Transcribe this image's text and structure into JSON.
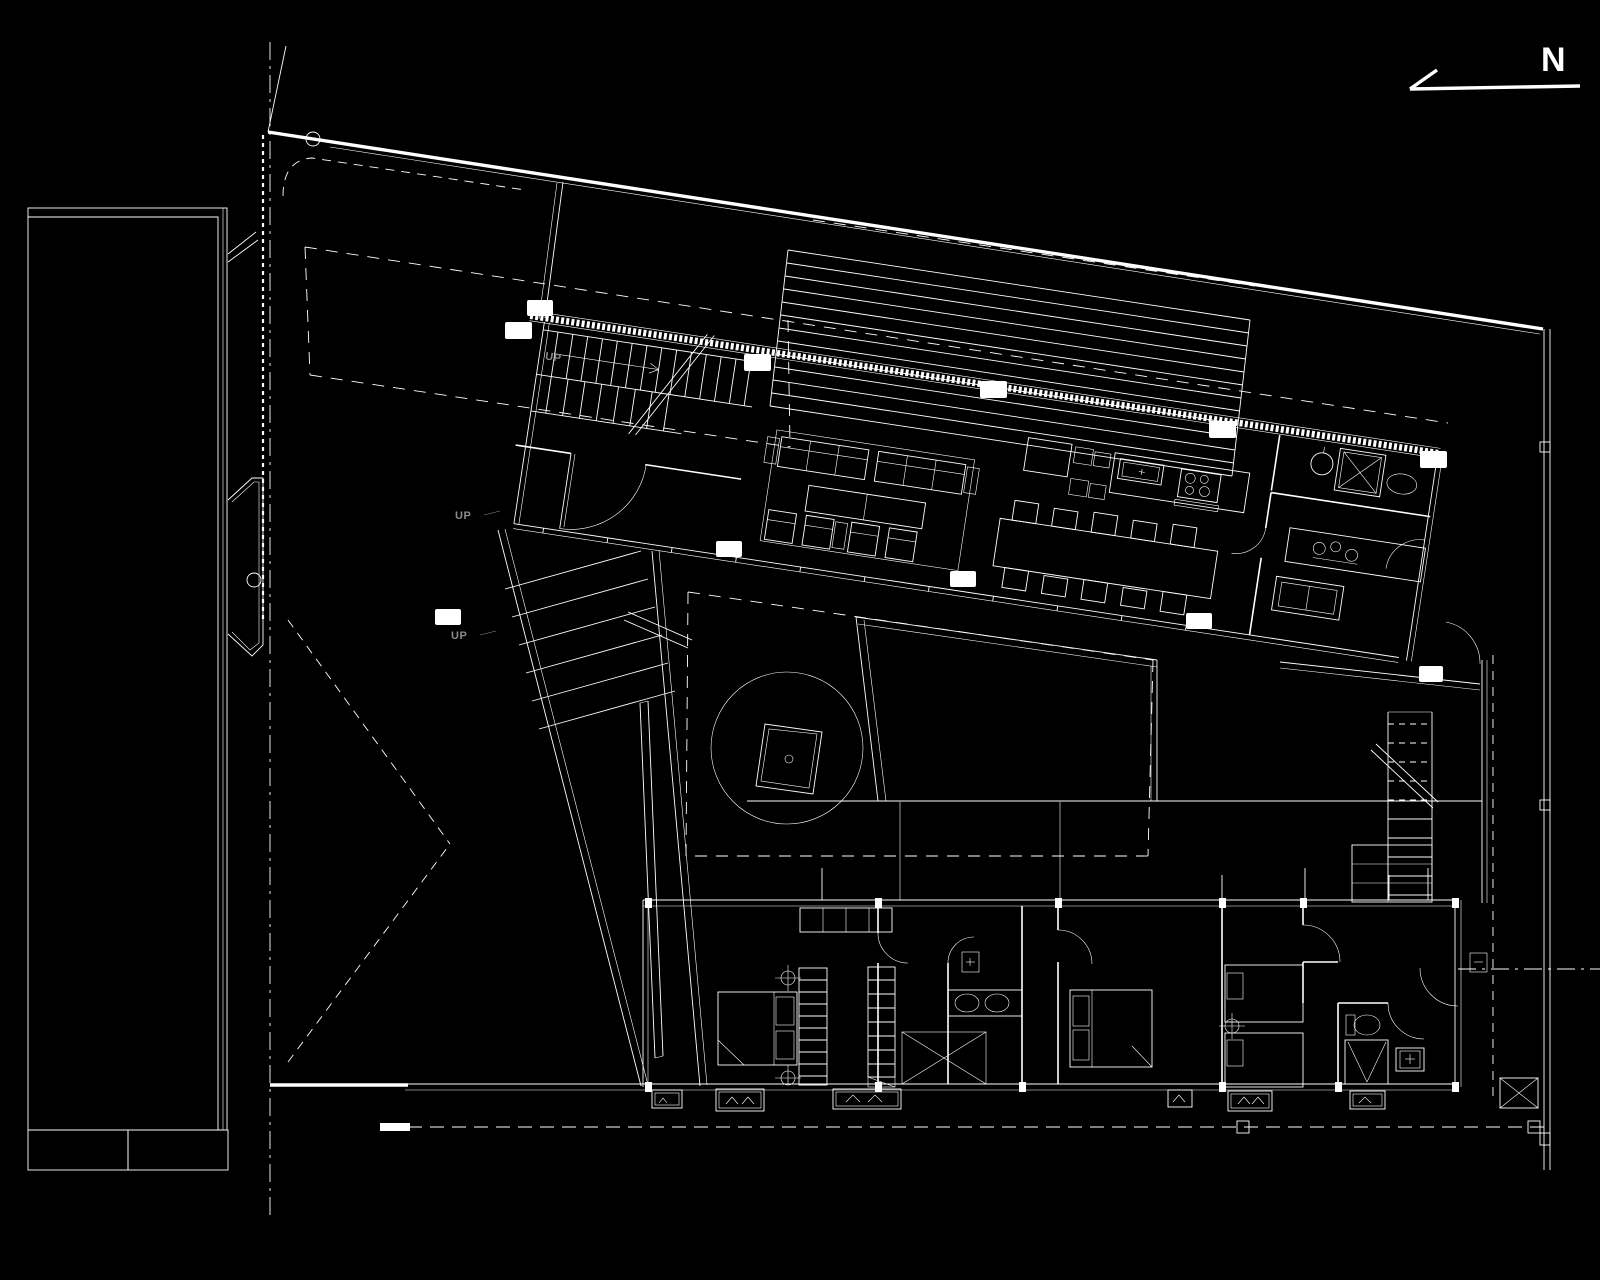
{
  "canvas": {
    "width": 1600,
    "height": 1280,
    "background_color": "#000000",
    "line_color": "#ffffff",
    "muted_label_color": "#8b8b8b"
  },
  "compass": {
    "label": "N"
  },
  "labels": {
    "up": "UP"
  }
}
